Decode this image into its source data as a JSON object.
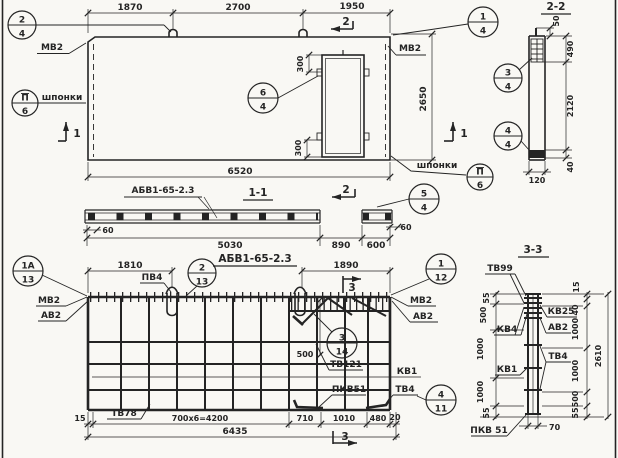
{
  "panel_plan": {
    "dims": {
      "top_left": "1870",
      "top_mid": "2700",
      "top_right": "1950",
      "opening_top": "300",
      "opening_bottom": "300",
      "height": "2650",
      "width": "6520"
    },
    "labels": {
      "mv2_left": "МВ2",
      "mv2_right": "МВ2",
      "keys_left": "шпонки",
      "keys_right": "шпонки"
    },
    "marks": {
      "cut1_left": "1",
      "cut1_right": "1",
      "cut2_top": "2"
    },
    "callouts": {
      "c24": {
        "num": "2",
        "den": "4"
      },
      "cp6_left": {
        "num": "П",
        "den": "6"
      },
      "c64": {
        "num": "6",
        "den": "4"
      },
      "c14": {
        "num": "1",
        "den": "4"
      },
      "cp6_right": {
        "num": "П",
        "den": "6"
      }
    }
  },
  "section_2_2": {
    "title": "2-2",
    "dims": {
      "d50": "50",
      "d490": "490",
      "d2120": "2120",
      "d40": "40",
      "d120": "120"
    },
    "callouts": {
      "c34": {
        "num": "3",
        "den": "4"
      },
      "c44": {
        "num": "4",
        "den": "4"
      }
    }
  },
  "section_1_1": {
    "title": "1-1",
    "panel_mark": "АБВ1-65-2.3",
    "dims": {
      "d60_left": "60",
      "d5030": "5030",
      "d890": "890",
      "d600": "600",
      "d60_right": "60"
    },
    "marks": {
      "cut2_bottom": "2"
    },
    "callouts": {
      "c54": {
        "num": "5",
        "den": "4"
      }
    }
  },
  "cage_plan": {
    "title": "АБВ1-65-2.3",
    "dims": {
      "d1810": "1810",
      "d1890": "1890",
      "d500": "500",
      "d15": "15",
      "d4200": "700x6=4200",
      "d710": "710",
      "d1010": "1010",
      "d480": "480",
      "d20": "20",
      "d6435": "6435"
    },
    "labels": {
      "pv4": "ПВ4",
      "mv2_left": "МВ2",
      "av2_left": "АВ2",
      "mv2_right": "МВ2",
      "av2_right": "АВ2",
      "tv121": "ТВ121",
      "kv1": "КВ1",
      "pkv51": "ПКВ51",
      "tv4": "ТВ4",
      "tv78": "ТВ78"
    },
    "marks": {
      "cut3_top": "3",
      "cut3_bottom": "3"
    },
    "callouts": {
      "c1a13": {
        "num": "1А",
        "den": "13"
      },
      "c213": {
        "num": "2",
        "den": "13"
      },
      "c112": {
        "num": "1",
        "den": "12"
      },
      "c314": {
        "num": "3",
        "den": "14"
      },
      "c411": {
        "num": "4",
        "den": "11"
      }
    }
  },
  "section_3_3": {
    "title": "3-3",
    "labels": {
      "tv99": "ТВ99",
      "kv25": "КВ25",
      "av2": "АВ2",
      "kv4": "КВ4",
      "tv4": "ТВ4",
      "kv1": "КВ1",
      "pkv51": "ПКВ 51"
    },
    "dims_left": {
      "t55": "55",
      "d500": "500",
      "d1000a": "1000",
      "d1000b": "1000",
      "b55": "55"
    },
    "dims_right": {
      "d15": "15",
      "d40": "40",
      "d1000a": "1000",
      "d1000b": "1000",
      "d500": "500",
      "d55": "55"
    },
    "dims": {
      "total": "2610",
      "width": "70"
    }
  }
}
